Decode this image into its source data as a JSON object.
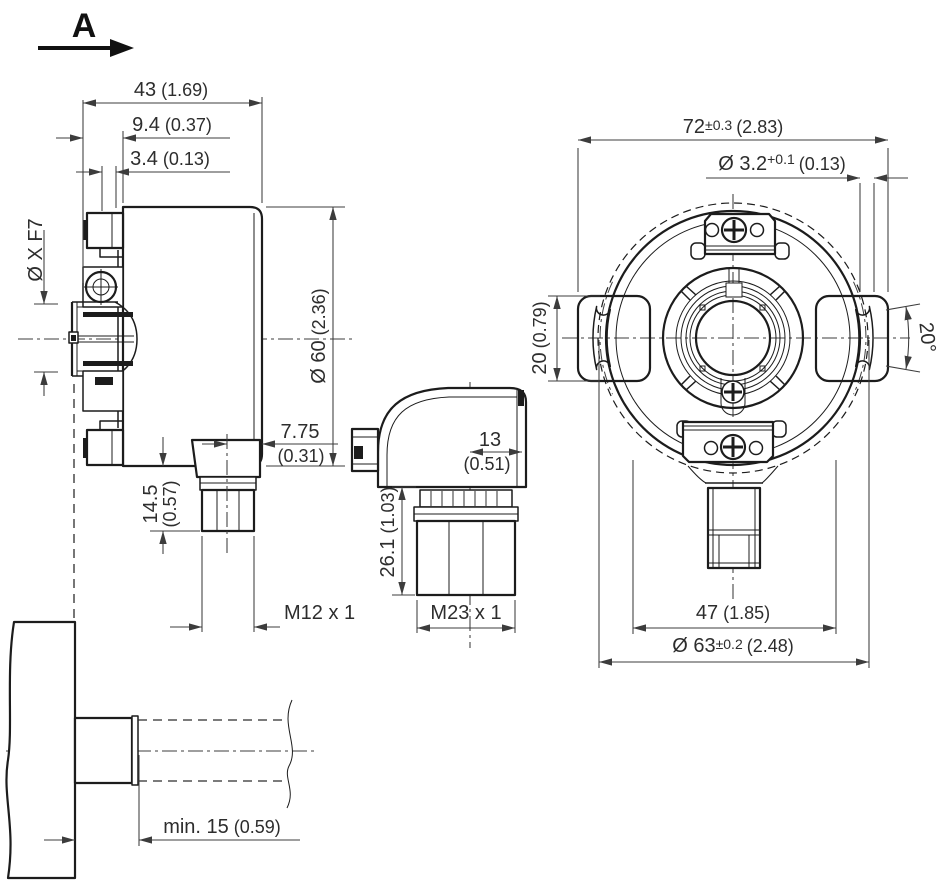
{
  "view_arrow": {
    "label": "A"
  },
  "side_view": {
    "dim_total": {
      "mm": "43",
      "inch": "(1.69)"
    },
    "dim_face": {
      "mm": "9.4",
      "inch": "(0.37)"
    },
    "dim_step": {
      "mm": "3.4",
      "inch": "(0.13)"
    },
    "dim_bore": {
      "label": "Ø X F7"
    },
    "dim_body": {
      "mm": "Ø 60",
      "inch": "(2.36)"
    },
    "dim_conn_offset": {
      "mm": "7.75",
      "inch": "(0.31)"
    },
    "dim_conn_height": {
      "mm": "14.5",
      "inch": "(0.57)"
    },
    "thread_m12": "M12 x 1",
    "dim_shaft_min": {
      "mm": "min. 15",
      "inch": "(0.59)"
    }
  },
  "connector_view": {
    "dim_width": {
      "mm": "13",
      "inch": "(0.51)"
    },
    "dim_height": {
      "mm": "26.1",
      "inch": "(1.03)"
    },
    "thread_m23": "M23 x 1"
  },
  "front_view": {
    "dim_width": {
      "mm": "72",
      "tol": "±0.3",
      "inch": "(2.83)"
    },
    "dim_hole": {
      "mm": "Ø 3.2",
      "tol": "+0.1",
      "inch": "(0.13)"
    },
    "dim_tab": {
      "mm": "20",
      "inch": "(0.79)"
    },
    "angle": "20°",
    "dim_47": {
      "mm": "47",
      "inch": "(1.85)"
    },
    "dim_bolt_circle": {
      "mm": "Ø 63",
      "tol": "±0.2",
      "inch": "(2.48)"
    }
  }
}
